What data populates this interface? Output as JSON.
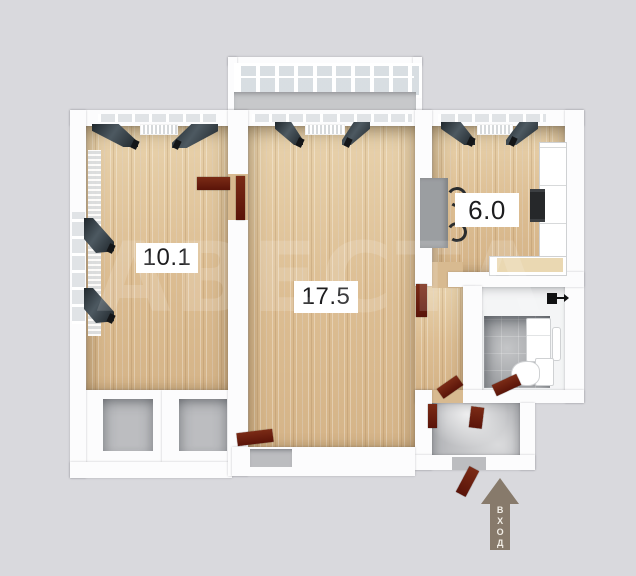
{
  "title": "apartment-floor-plan",
  "rooms": [
    {
      "key": "room-small",
      "area": "10.1"
    },
    {
      "key": "room-living",
      "area": "17.5"
    },
    {
      "key": "room-kitchen",
      "area": "6.0"
    }
  ],
  "entrance": {
    "label": "ВХОД"
  },
  "watermark": {
    "text": "АВЕСТА"
  },
  "colors": {
    "background": "#d9d9dd",
    "wall": "#ffffff",
    "wood_floor": "#dcbf97",
    "tile_floor": "#a5a7aa",
    "hall_floor": "#bcbdc0",
    "door": "#6b1e10",
    "curtain": "#39444a",
    "entrance_arrow": "#877a6b",
    "label_text": "#1d1d1f",
    "counter_accent": "#ead8b2"
  },
  "icons": {
    "entrance-arrow": "▲",
    "vent": "■",
    "objects": [
      "balcony-windows",
      "curtain",
      "radiator",
      "dining-table",
      "chair",
      "kitchen-cabinets",
      "stove",
      "kitchen-counter",
      "washing-machine",
      "towel-rail",
      "toilet",
      "door",
      "closet"
    ]
  }
}
